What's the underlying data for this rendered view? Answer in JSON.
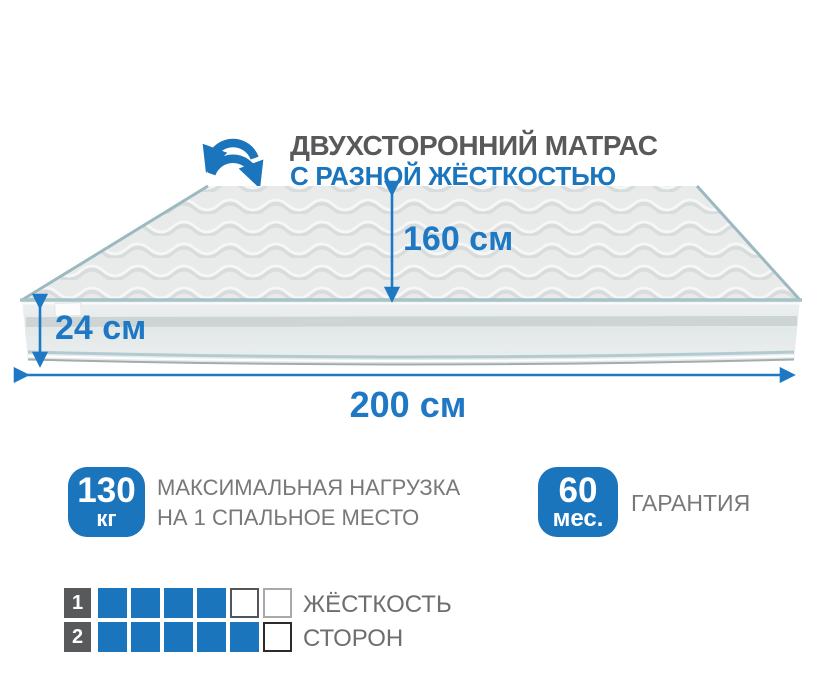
{
  "colors": {
    "accent_blue": "#1b75bc",
    "arrow_blue": "#1e78c4",
    "title_gray": "#58595b",
    "text_gray": "#77787a",
    "label_gray": "#6d6e70",
    "number_square_gray": "#58595b",
    "square_blue": "#1b75bc",
    "piping_teal": "#a6c3c9",
    "band_stripe": "#ccd4d4"
  },
  "header": {
    "icon": "rotate-two-sided-icon",
    "title": "ДВУХСТОРОННИЙ МАТРАС",
    "subtitle": "С РАЗНОЙ ЖЁСТКОСТЬЮ"
  },
  "mattress": {
    "width_label": "160 см",
    "height_label": "24 см",
    "length_label": "200 см"
  },
  "features": [
    {
      "badge_value": "130",
      "badge_unit": "кг",
      "caption_line1": "МАКСИМАЛЬНАЯ НАГРУЗКА",
      "caption_line2": "НА 1 СПАЛЬНОЕ МЕСТО"
    },
    {
      "badge_value": "60",
      "badge_unit": "мес.",
      "caption_line1": "ГАРАНТИЯ",
      "caption_line2": ""
    }
  ],
  "firmness_scale": {
    "label_line1": "ЖЁСТКОСТЬ",
    "label_line2": "СТОРОН",
    "cells_total": 6,
    "rows": [
      {
        "side": "1",
        "filled": 4,
        "empty": 2,
        "empty_borders": [
          "#54555a",
          "#a7a9ab"
        ]
      },
      {
        "side": "2",
        "filled": 5,
        "empty": 1,
        "empty_borders": [
          "#2b2b2d"
        ]
      }
    ]
  }
}
